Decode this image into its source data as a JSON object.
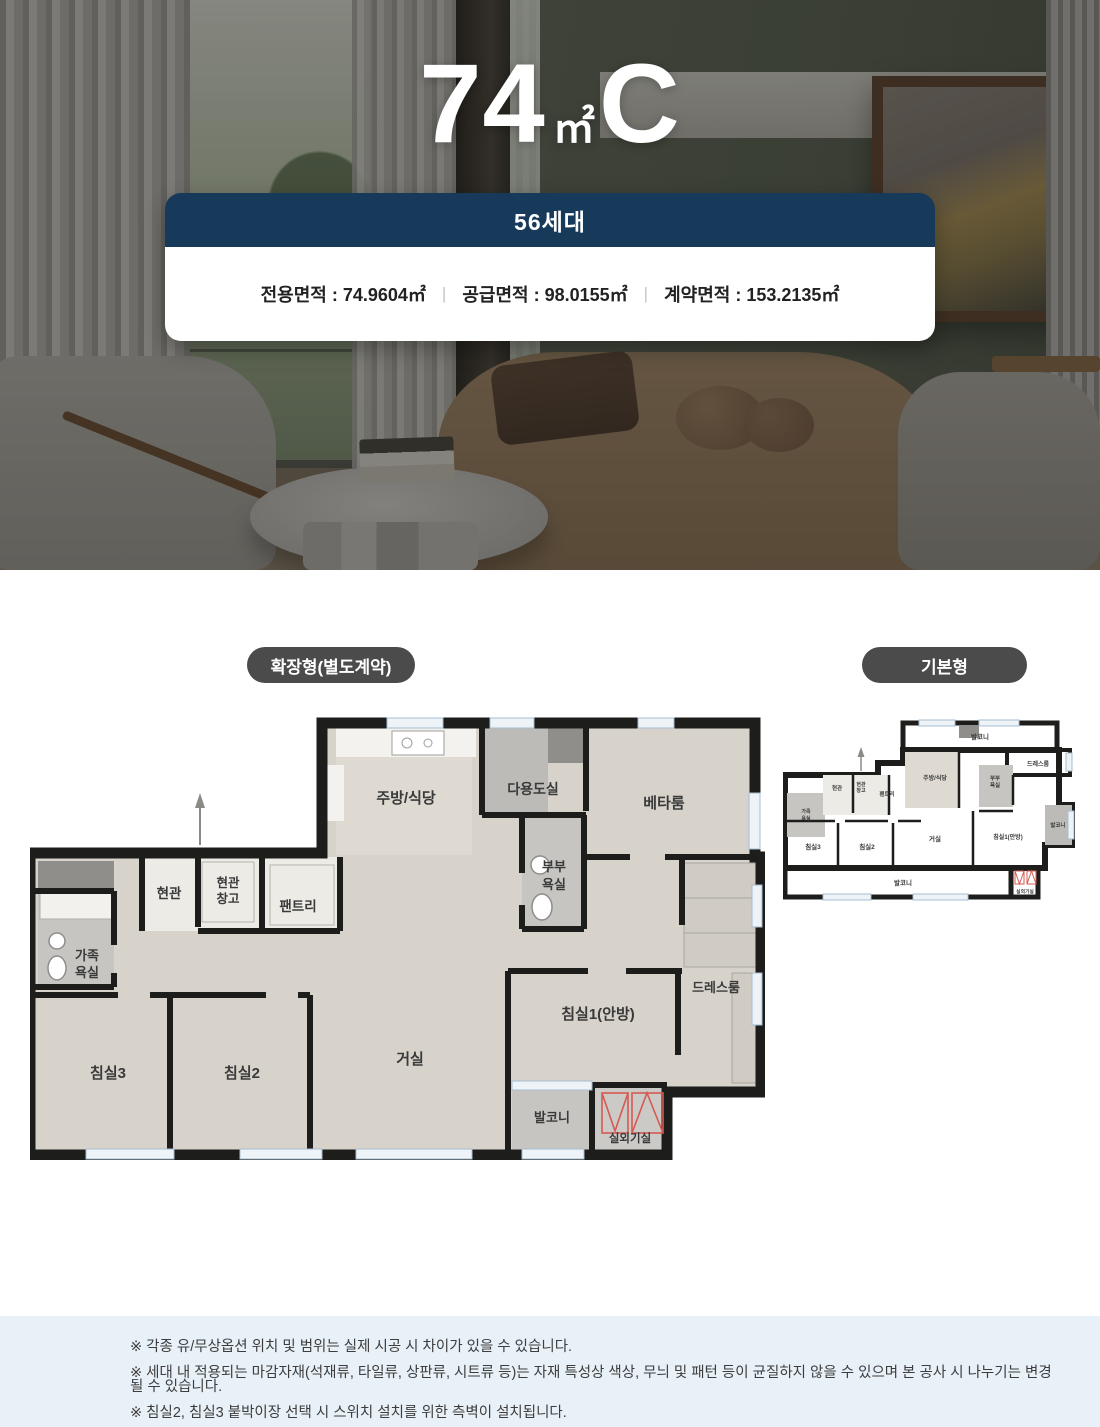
{
  "hero": {
    "title_number": "74",
    "title_unit": "㎡",
    "title_type": "C",
    "units_badge": "56세대",
    "area_items": [
      "전용면적 : 74.9604㎡",
      "공급면적 : 98.0155㎡",
      "계약면적 : 153.2135㎡"
    ],
    "divider": "|"
  },
  "plans": {
    "expanded_badge": "확장형(별도계약)",
    "basic_badge": "기본형"
  },
  "room_labels": {
    "kitchen": "주방/식당",
    "utility": "다용도실",
    "beta_room": "베타룸",
    "couple_bath_1": "부부",
    "couple_bath_2": "욕실",
    "entrance": "현관",
    "entrance_storage_1": "현관",
    "entrance_storage_2": "창고",
    "pantry": "팬트리",
    "family_bath_1": "가족",
    "family_bath_2": "욕실",
    "dress_room": "드레스룸",
    "bedroom1": "침실1(안방)",
    "living": "거실",
    "bedroom2": "침실2",
    "bedroom3": "침실3",
    "balcony": "발코니",
    "ac_room": "실외기실"
  },
  "notes": [
    "※ 각종 유/무상옵션 위치 및 범위는 실제 시공 시 차이가 있을 수 있습니다.",
    "※ 세대 내 적용되는 마감자재(석재류, 타일류, 상판류, 시트류 등)는 자재 특성상 색상, 무늬 및 패턴 등이 균질하지 않을 수 있으며 본 공사 시 나누기는 변경될 수 있습니다.",
    "※ 침실2, 침실3 붙박이장 선택 시 스위치 설치를 위한 측벽이 설치됩니다."
  ],
  "colors": {
    "navy": "#17395a",
    "badge_gray": "#4b4b4b",
    "notes_bg": "#e8f1f8",
    "wall_black": "#1d1d1b",
    "floor_wood": "#d7d3cb",
    "tile_gray": "#c6c5c1",
    "window_blue": "#eef3f8",
    "ac_red": "#d65a52"
  }
}
